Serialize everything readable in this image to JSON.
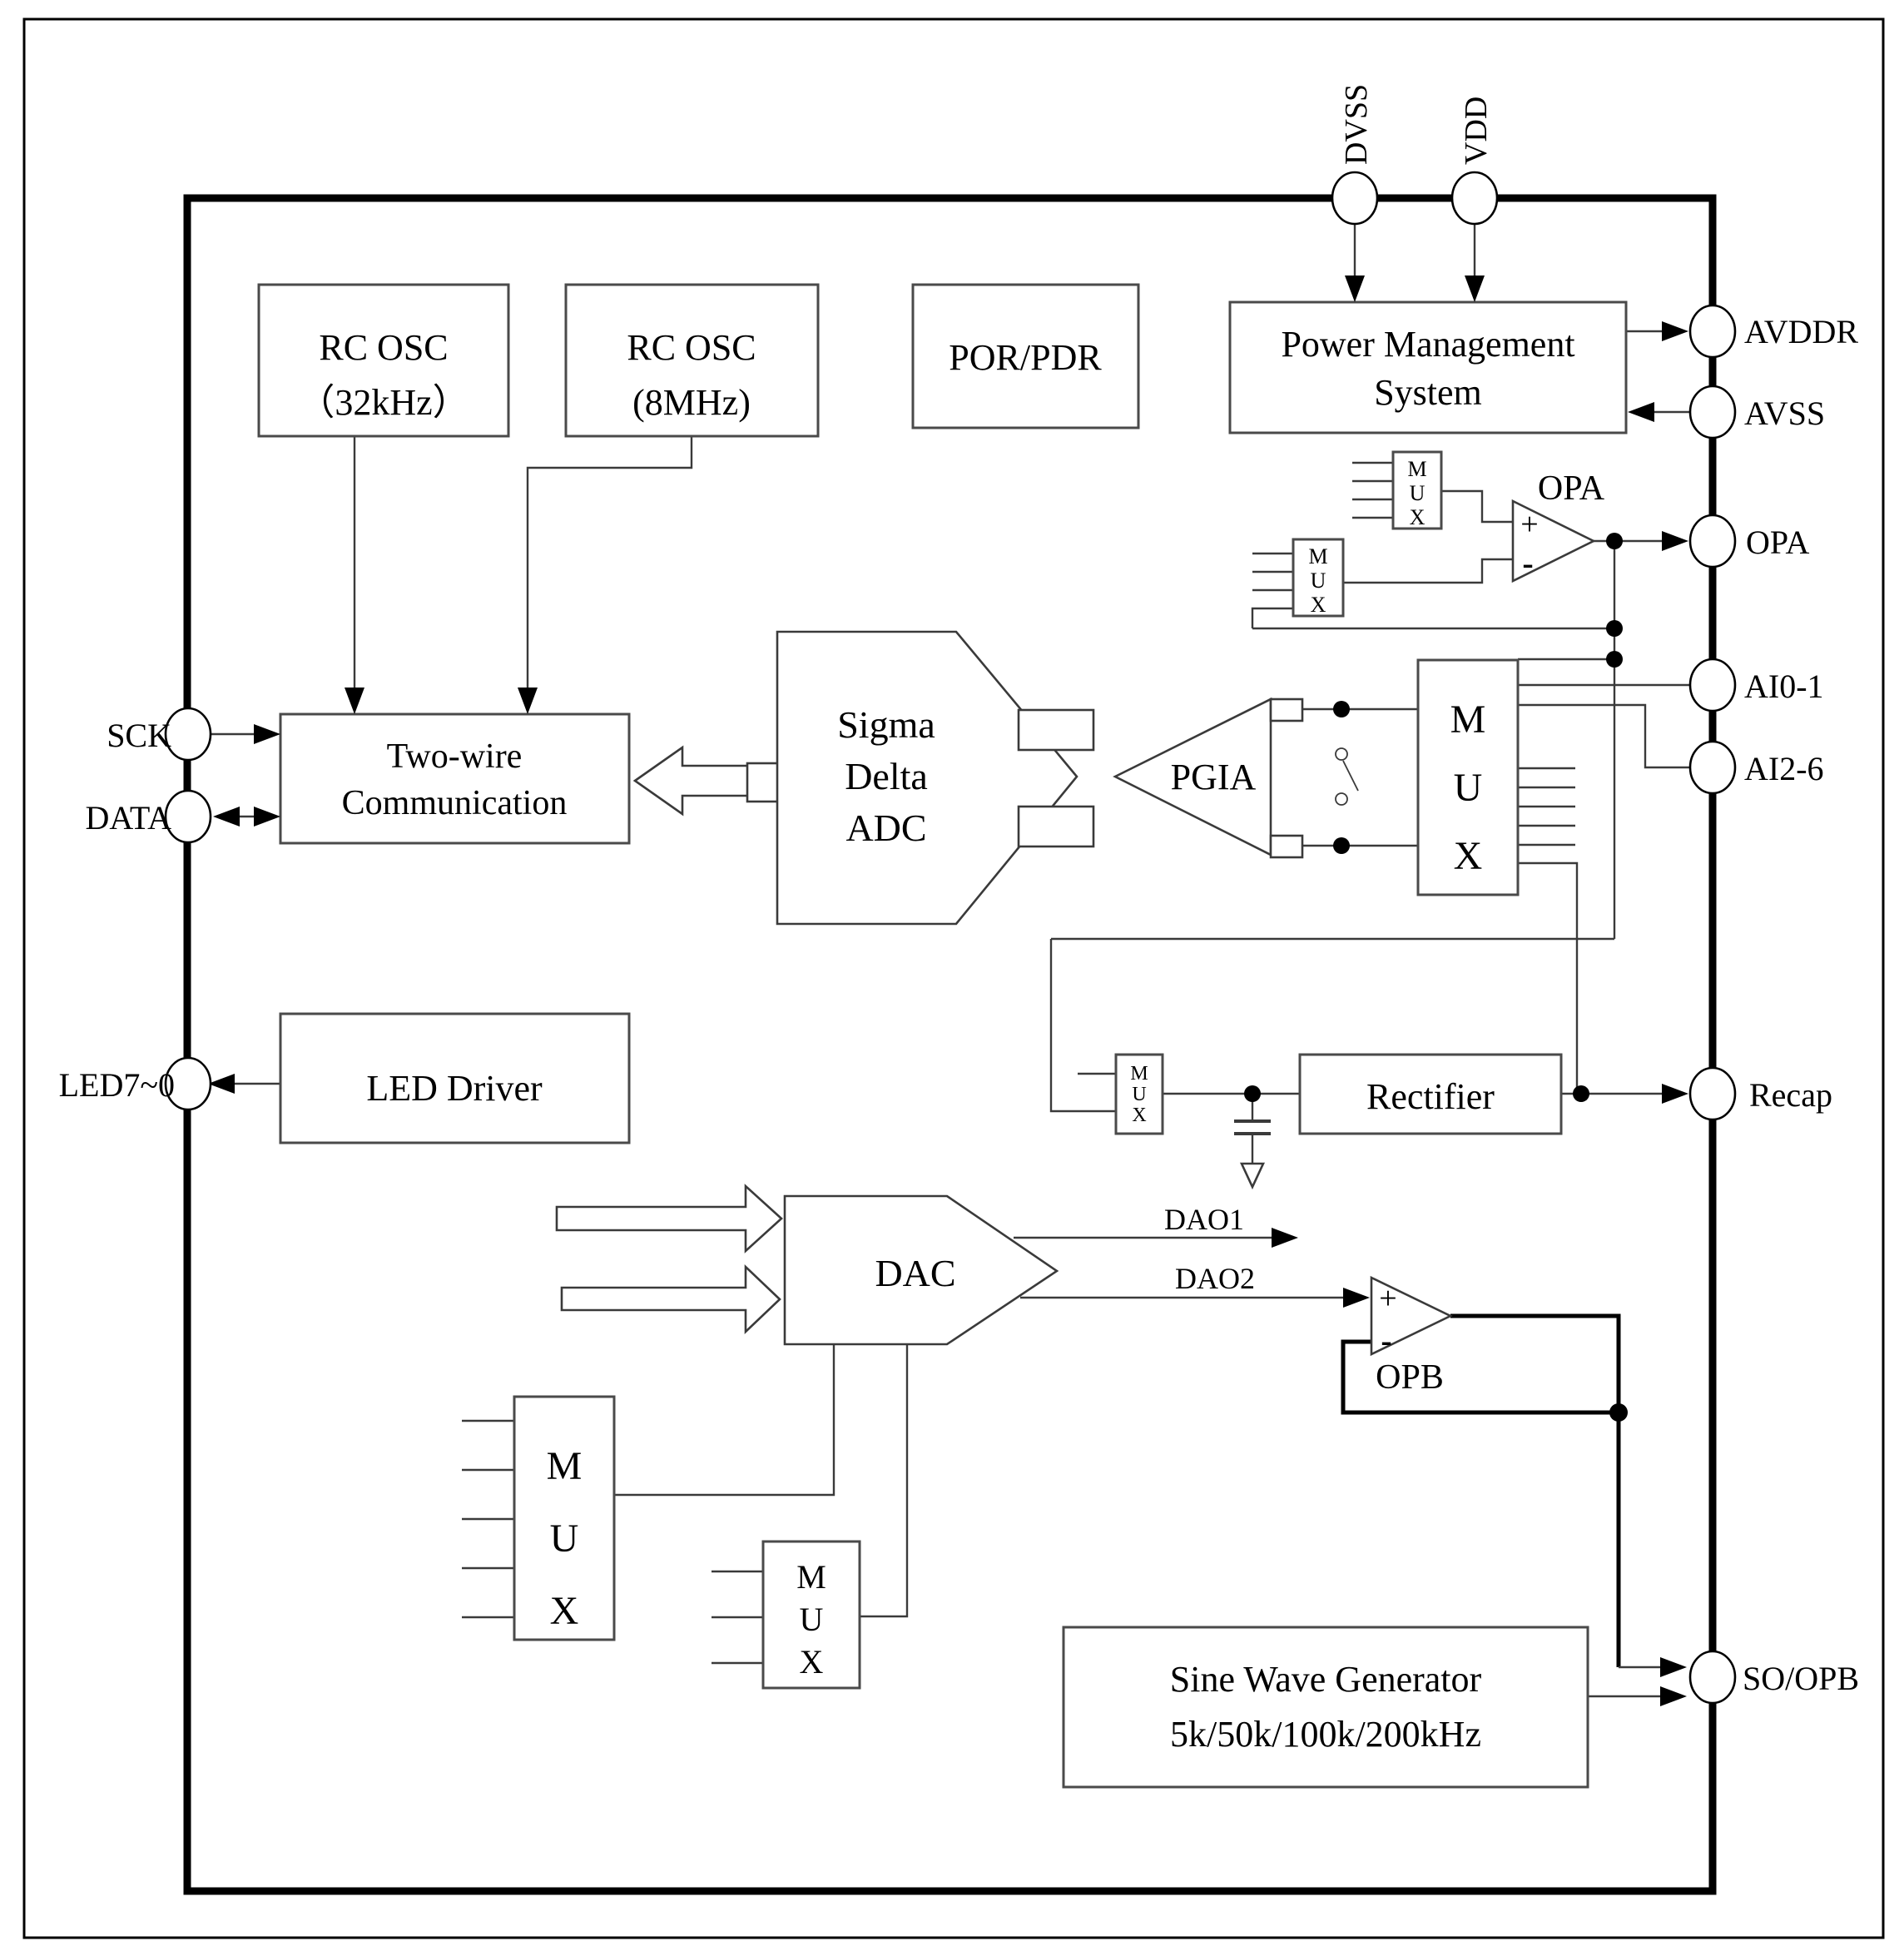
{
  "pins": {
    "dvss": "DVSS",
    "vdd": "VDD",
    "avddr": "AVDDR",
    "avss": "AVSS",
    "opa": "OPA",
    "ai01": "AI0-1",
    "ai26": "AI2-6",
    "recap": "Recap",
    "so_opb": "SO/OPB",
    "sck": "SCK",
    "data": "DATA",
    "led": "LED7~0"
  },
  "blocks": {
    "rc_osc_32": {
      "line1": "RC OSC",
      "line2": "（32kHz）"
    },
    "rc_osc_8": {
      "line1": "RC OSC",
      "line2": "(8MHz)"
    },
    "por_pdr": "POR/PDR",
    "power_mgmt": {
      "line1": "Power Management",
      "line2": "System"
    },
    "two_wire": {
      "line1": "Two-wire",
      "line2": "Communication"
    },
    "led_driver": "LED Driver",
    "sigma_delta": {
      "line1": "Sigma",
      "line2": "Delta",
      "line3": "ADC"
    },
    "pgia": "PGIA",
    "dac": "DAC",
    "rectifier": "Rectifier",
    "sine_gen": {
      "line1": "Sine Wave Generator",
      "line2": "5k/50k/100k/200kHz"
    },
    "opa_amp": "OPA",
    "opb_amp": "OPB"
  },
  "mux": {
    "l1": "M",
    "l2": "U",
    "l3": "X"
  },
  "signals": {
    "dao1": "DAO1",
    "dao2": "DAO2"
  },
  "opamp": {
    "plus": "+",
    "minus": "-"
  },
  "colors": {
    "wire": "#3a3a3a",
    "border": "#000000",
    "block_stroke": "#4a4a4a"
  }
}
